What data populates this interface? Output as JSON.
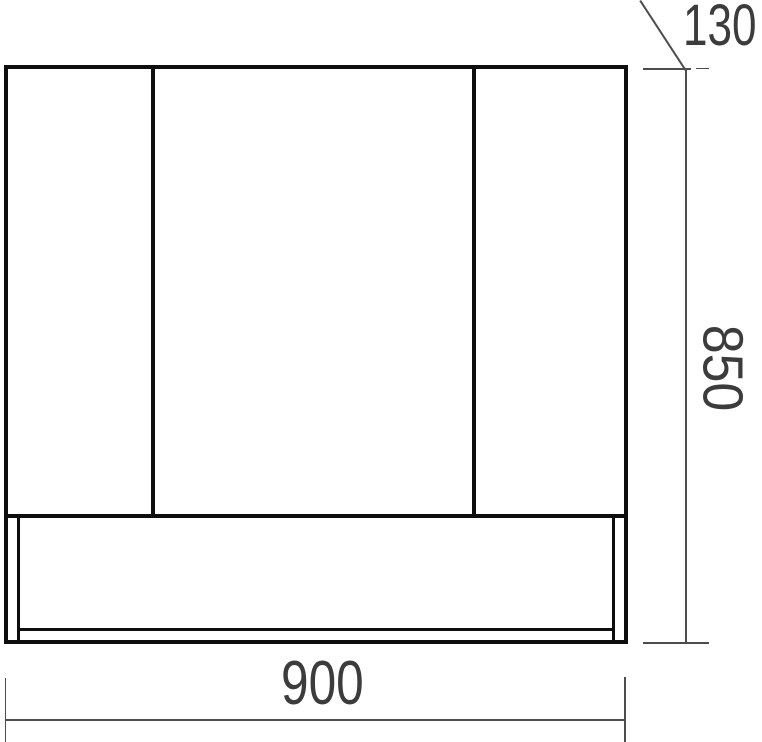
{
  "diagram": {
    "description": "front elevation technical drawing of a three-door cabinet with bottom panel",
    "background_color": "#ffffff",
    "outline_color": "#0e0e0e",
    "dimension_line_color": "#4d4d4d",
    "dimension_text_color": "#3c3c3c",
    "dimensions": {
      "width": {
        "value": "900",
        "orientation": "horizontal",
        "position": "bottom"
      },
      "height": {
        "value": "850",
        "orientation": "vertical-rotated-90",
        "position": "right"
      },
      "top_detail": {
        "value": "130",
        "orientation": "leader-line",
        "position": "top-right"
      }
    }
  }
}
